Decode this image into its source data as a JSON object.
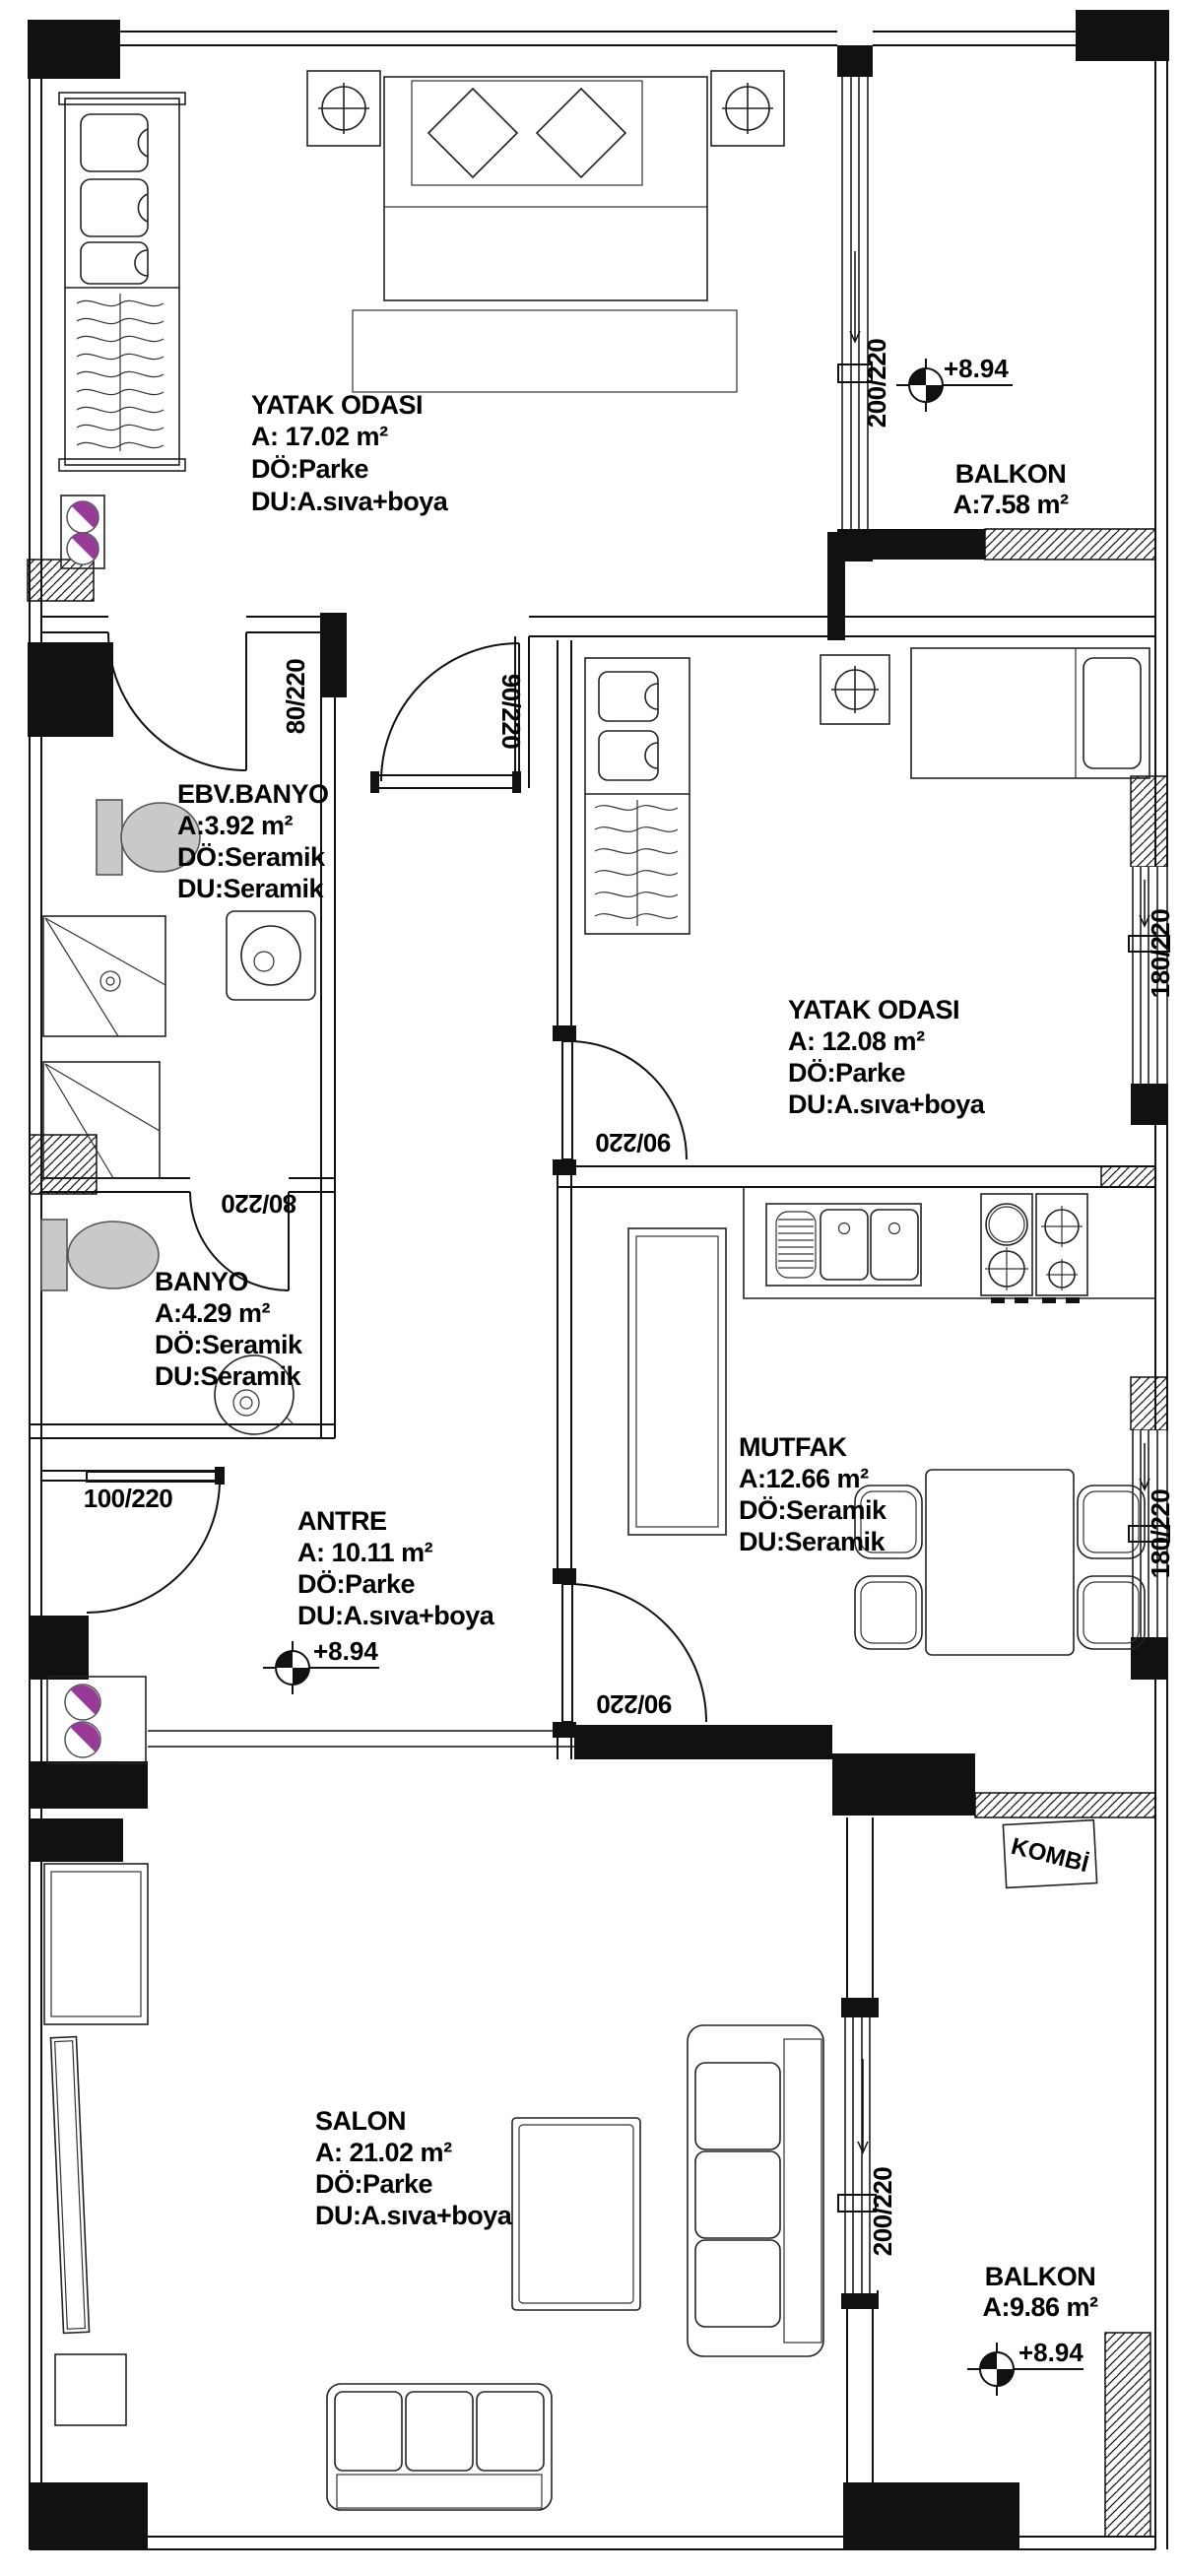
{
  "drawing": {
    "rooms": {
      "bedroom1": {
        "name": "YATAK ODASI",
        "area": "A: 17.02 m²",
        "floor": "DÖ:Parke",
        "wall": "DU:A.sıva+boya"
      },
      "balcony1": {
        "name": "BALKON",
        "area": "A:7.58 m²"
      },
      "ebv_banyo": {
        "name": "EBV.BANYO",
        "area": "A:3.92 m²",
        "floor": "DÖ:Seramik",
        "wall": "DU:Seramik"
      },
      "bedroom2": {
        "name": "YATAK ODASI",
        "area": "A: 12.08 m²",
        "floor": "DÖ:Parke",
        "wall": "DU:A.sıva+boya"
      },
      "banyo": {
        "name": "BANYO",
        "area": "A:4.29 m²",
        "floor": "DÖ:Seramik",
        "wall": "DU:Seramik"
      },
      "antre": {
        "name": "ANTRE",
        "area": "A: 10.11 m²",
        "floor": "DÖ:Parke",
        "wall": "DU:A.sıva+boya"
      },
      "mutfak": {
        "name": "MUTFAK",
        "area": "A:12.66 m²",
        "floor": "DÖ:Seramik",
        "wall": "DU:Seramik"
      },
      "salon": {
        "name": "SALON",
        "area": "A: 21.02 m²",
        "floor": "DÖ:Parke",
        "wall": "DU:A.sıva+boya"
      },
      "balcony2": {
        "name": "BALKON",
        "area": "A:9.86 m²"
      },
      "kombi": {
        "name": "KOMBİ"
      }
    },
    "openings": {
      "door80": "80/220",
      "door90": "90/220",
      "door100": "100/220",
      "window180": "180/220",
      "window200": "200/220"
    },
    "elevation": "+8.94",
    "colors": {
      "line": "#111111",
      "slipper_accent": "#993a99",
      "fixture_gray": "#c9c9c9"
    }
  }
}
